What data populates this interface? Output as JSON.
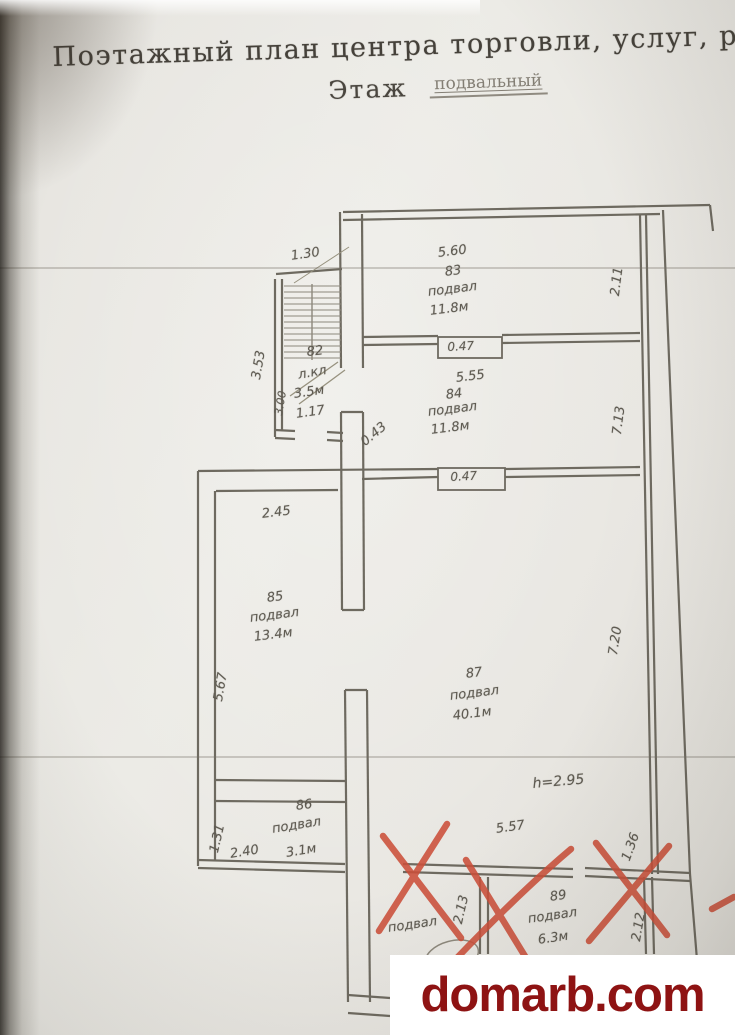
{
  "page": {
    "title": "Поэтажный план центра торговли, услуг, ра",
    "floor_label": "Этаж",
    "floor_value": "подвальный"
  },
  "plan": {
    "stair": {
      "dim_width": "1.30",
      "dim_left_outer": "3.53",
      "dim_left_inner": "3.00",
      "number": "82",
      "type": "л.кл",
      "area": "3.5м",
      "door_width": "1.17"
    },
    "rooms": {
      "r83": {
        "number": "83",
        "type": "подвал",
        "area": "11.8м",
        "dim_width": "5.60",
        "dim_right": "2.11",
        "door_width": "0.47"
      },
      "r84": {
        "number": "84",
        "type": "подвал",
        "area": "11.8м",
        "dim_width": "5.55",
        "dim_right": "7.13",
        "door_width": "0.47",
        "dim_opening": "0.43"
      },
      "r85": {
        "number": "85",
        "type": "подвал",
        "area": "13.4м",
        "dim_top": "2.45",
        "dim_left": "5.67"
      },
      "r86": {
        "number": "86",
        "type": "подвал",
        "area": "3.1м",
        "dim_bottom": "2.40",
        "dim_left": "1.31"
      },
      "r87": {
        "number": "87",
        "type": "подвал",
        "area": "40.1м",
        "dim_right": "7.20",
        "ceiling_height": "h=2.95"
      },
      "r88": {
        "type": "подвал"
      },
      "r89": {
        "number": "89",
        "type": "подвал",
        "area": "6.3м",
        "dim_top": "5.57",
        "dim_left": "2.13",
        "dim_right": "2.12",
        "dim_corner": "1.36"
      }
    }
  },
  "watermark": {
    "text": "domarb.com",
    "color": "#8e1313"
  }
}
